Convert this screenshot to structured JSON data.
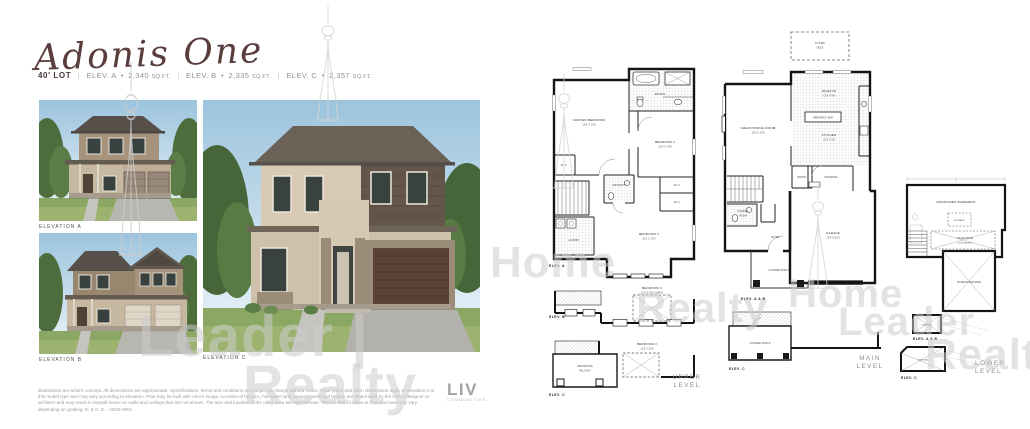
{
  "header": {
    "title": "Adonis One",
    "lot": "40' LOT",
    "sep": "|",
    "specs": [
      {
        "name": "ELEV. A",
        "bullet": "•",
        "sqft": "2,340",
        "unit": "SQ.FT."
      },
      {
        "name": "ELEV. B",
        "bullet": "•",
        "sqft": "2,335",
        "unit": "SQ.FT."
      },
      {
        "name": "ELEV. C",
        "bullet": "•",
        "sqft": "2,357",
        "unit": "SQ.FT."
      }
    ]
  },
  "elevations": [
    {
      "label": "ELEVATION A"
    },
    {
      "label": "ELEVATION B"
    },
    {
      "label": "ELEVATION C"
    }
  ],
  "logo": {
    "name": "LIV",
    "tagline": "COMMUNITIES"
  },
  "disclaimer": "Illustrations are artist's concept. All dimensions are approximate. Specifications, terms and conditions are subject to change without notice. Floor plans and room dimensions apply to elevation A of this model type and may vary according to elevation. Plan may be built with mirror image. Location of furnace, hot water tank, support posts and beams are determined by the HVAC designer or architect and may result in drywall boxes on walls and ceilings that are not shown. The size and location of the utility area are approximate. The number of steps at front and rear may vary depending on grading. E. & O. E. - N040-0001",
  "plans": {
    "upper": {
      "title1": "UPPER",
      "title2": "LEVEL",
      "elev_a": "ELEV. A",
      "elev_b": "ELEV. B",
      "elev_c": "ELEV. C",
      "master": "MASTER BEDROOM",
      "master_dims": "16'4 X 13'6",
      "ensuite": "ENSUITE",
      "bedroom2": "BEDROOM 2",
      "bedroom2_dims": "12'4 X 10'8",
      "main_bath": "MAIN BATH",
      "wic_a": "W.I.C.",
      "wic_b": "W.I.C.",
      "wic_master": "W.I.C.",
      "laundry": "LAUNDRY",
      "bedroom3": "BEDROOM 3",
      "bedroom3_dims": "11'6 X 10'0",
      "bedroom3_b": "BEDROOM 3",
      "bedroom3_b_dims": "11'6 X 10'0 (+BAY)",
      "bedroom3_c": "BEDROOM 3",
      "bedroom3_c_dims": "11'6 X 10'0",
      "balcony1": "DECORATIVE",
      "balcony2": "BALCONY"
    },
    "main": {
      "title1": "MAIN",
      "title2": "LEVEL",
      "elev_ab": "ELEV. A & B",
      "elev_c": "ELEV. C",
      "future1": "FUTURE",
      "future2": "DECK",
      "great": "GREAT/DINING ROOM",
      "great_dims": "18'0 X 13'0",
      "dinette": "DINETTE",
      "dinette_dims": "12'0 X 9'6",
      "kitchen": "KITCHEN",
      "kitchen_dims": "12'0 X 9'0",
      "island": "BREAKFAST BAR",
      "pantry": "PANTRY",
      "powder1": "POWDER",
      "powder2": "ROOM",
      "mudroom": "MUDROOM",
      "foyer": "FOYER",
      "garage": "GARAGE",
      "garage_dims": "19'4 X 20'4",
      "porch": "COVERED PORCH",
      "porch_c": "COVERED PORCH"
    },
    "lower": {
      "title1": "LOWER",
      "title2": "LEVEL",
      "elev_ab": "ELEV. A & B",
      "elev_c": "ELEV. C",
      "unfinished": "UNFINISHED BASEMENT",
      "furnace": "FURNACE",
      "crawl1": "CRAWLSPACE",
      "crawl2": "(LOW HEIGHT)",
      "unexcavated": "UNEXCAVATED",
      "unexc_ab": "UNEXCAV.",
      "unexc_c": "UNEXCAV."
    }
  },
  "watermarks": {
    "leader_left": "Leader |",
    "realty_left": "Realty",
    "home_mid": "Home",
    "realty_mid": "Realty",
    "home_right": "Home",
    "leader_right": "Leader",
    "realty_right": "Realty"
  },
  "colors": {
    "title": "#5a3d3d",
    "watermark": "#cdcdcd",
    "plan_line": "#141414",
    "level_label": "#8c8c8c",
    "logo_gray": "#a3a3a3"
  }
}
